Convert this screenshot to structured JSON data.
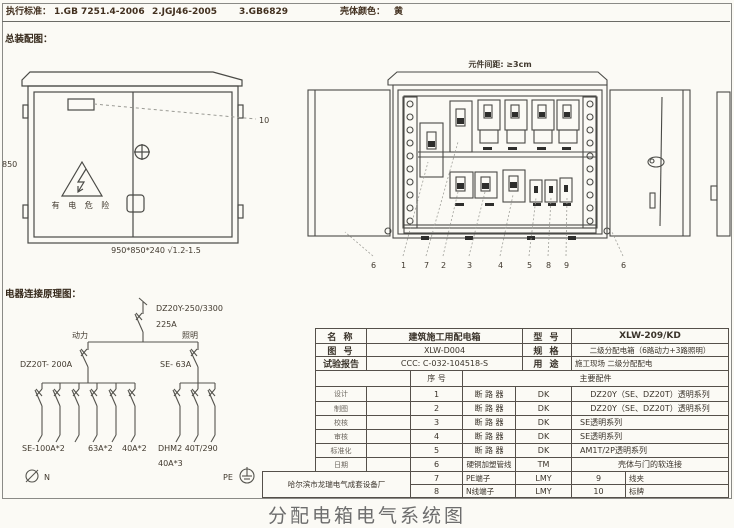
{
  "header": {
    "standards_label": "执行标准：",
    "standard_1": "1.GB 7251.4-2006",
    "standard_2": "2.JGJ46-2005",
    "standard_3": "3.GB6829",
    "shell_color_label": "壳体颜色：",
    "shell_color_value": "黄"
  },
  "assembly": {
    "section_title": "总装配图：",
    "height_dim": "850",
    "size_note": "950*850*240 √1.2-1.5",
    "leader_label": "10",
    "warning_text": "有 电 危 险"
  },
  "open_view": {
    "clearance_note": "元件间距: ≥3cm",
    "numbers": [
      "6",
      "1",
      "7",
      "2",
      "3",
      "4",
      "5",
      "8",
      "9",
      "6"
    ]
  },
  "schematic": {
    "section_title": "电器连接原理图：",
    "main_breaker_model": "DZ20Y-250/3300",
    "main_breaker_rating": "225A",
    "branch_power_label": "动力",
    "branch_lighting_label": "照明",
    "power_breaker": "DZ20T- 200A",
    "lighting_breaker": "SE- 63A",
    "power_outputs_1": "SE-100A*2",
    "power_outputs_2": "63A*2",
    "power_outputs_3": "40A*2",
    "lighting_outputs_1": "DHM2 40T/290",
    "lighting_outputs_2": "40A*3",
    "neutral_label": "N",
    "pe_label": "PE"
  },
  "spec_table": {
    "name_label": "名  称",
    "name_value": "建筑施工用配电箱",
    "model_label": "型  号",
    "model_value": "XLW-209/KD",
    "fig_label": "图  号",
    "fig_value": "XLW-D004",
    "spec_label": "规  格",
    "spec_value": "二级分配电箱（6路动力+3路照明）",
    "report_label": "试验报告",
    "report_value": "CCC: C-032-104518-S",
    "use_label": "用  途",
    "use_value": "施工现场 二级分配配电",
    "serial_header": "序  号",
    "parts_header": "主要配件",
    "sign_labels": [
      "设计",
      "制图",
      "校核",
      "审核",
      "标准化",
      "日期"
    ],
    "rows": [
      {
        "no": "1",
        "name": "断 路 器",
        "code": "DK",
        "desc": "DZ20Y（SE、DZ20T）透明系列"
      },
      {
        "no": "2",
        "name": "断 路 器",
        "code": "DK",
        "desc": "DZ20Y（SE、DZ20T）透明系列"
      },
      {
        "no": "3",
        "name": "断 路 器",
        "code": "DK",
        "desc": "SE透明系列"
      },
      {
        "no": "4",
        "name": "断 路 器",
        "code": "DK",
        "desc": "SE透明系列"
      },
      {
        "no": "5",
        "name": "断 路 器",
        "code": "DK",
        "desc": "AM1T/2P透明系列"
      },
      {
        "no": "6",
        "name": "硬铜加塑管线",
        "code": "TM",
        "desc": "壳体与门的软连接"
      }
    ],
    "rows2": [
      {
        "no": "7",
        "name": "PE端子",
        "code": "LMY",
        "no2": "9",
        "name2": "线夹"
      },
      {
        "no": "8",
        "name": "N线端子",
        "code": "LMY",
        "no2": "10",
        "name2": "标牌"
      }
    ],
    "factory": "哈尔滨市龙瑞电气成套设备厂"
  },
  "caption": "分配电箱电气系统图"
}
